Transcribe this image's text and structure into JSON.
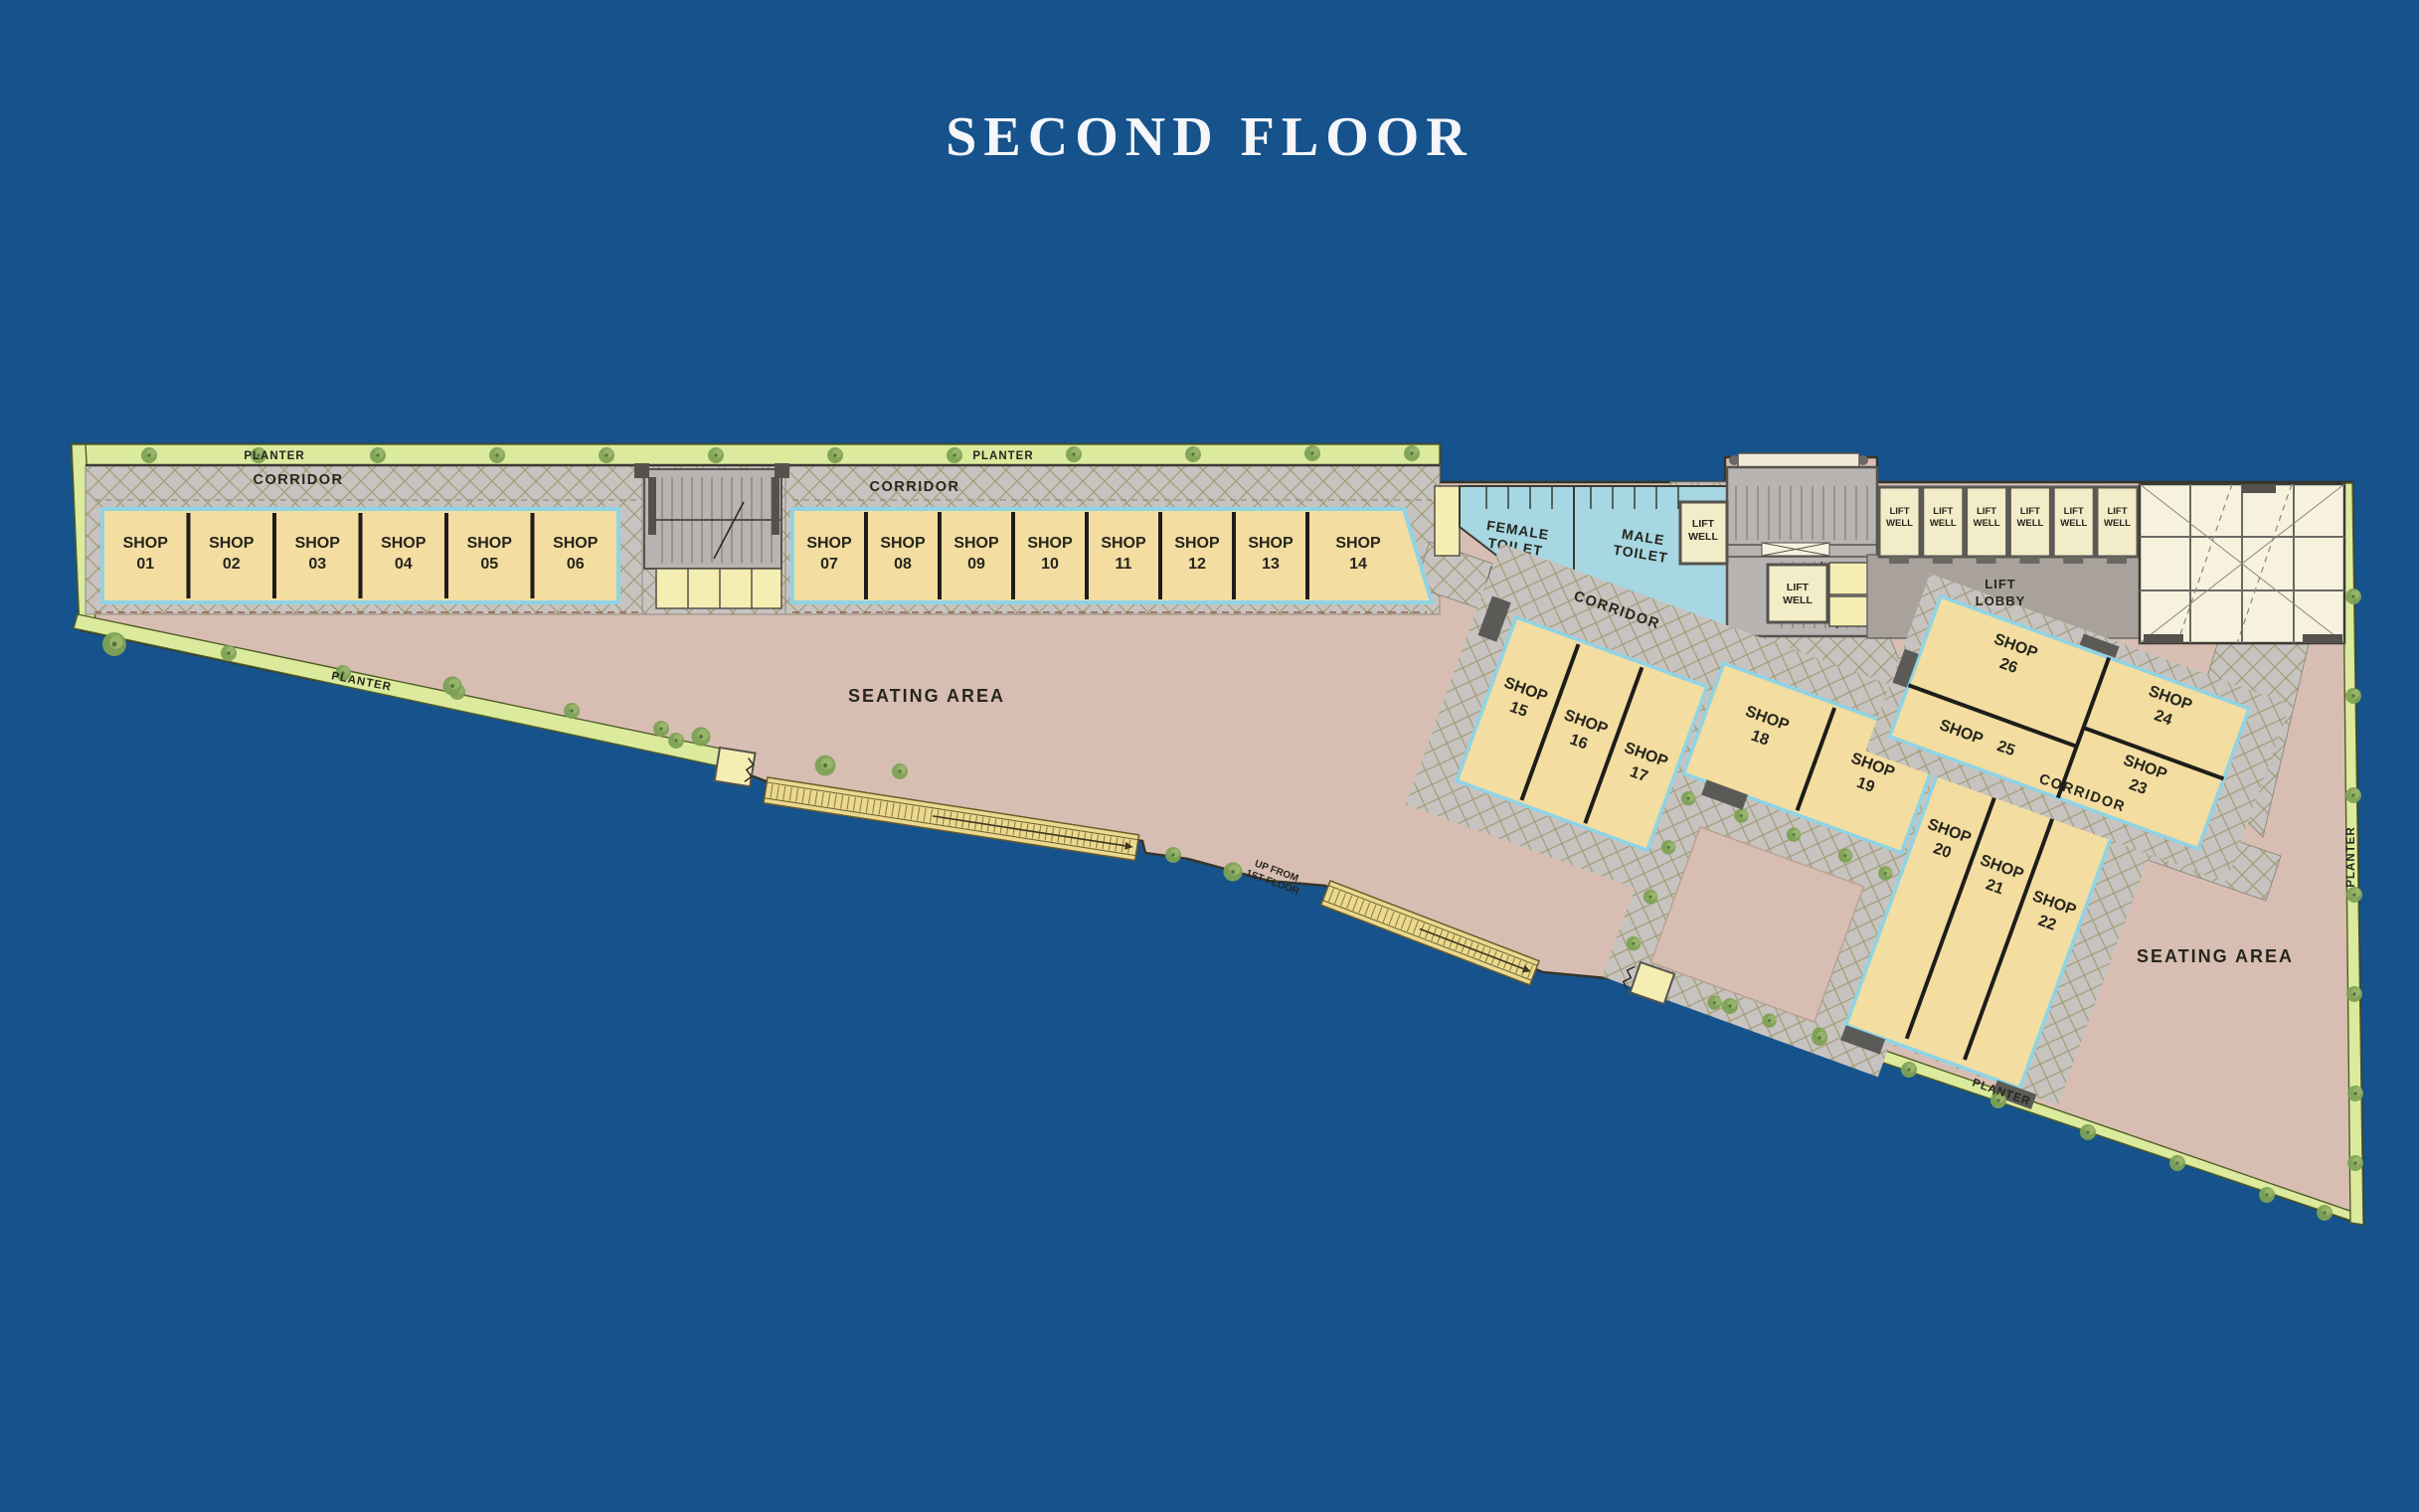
{
  "title": "SECOND FLOOR",
  "labels": {
    "shop_word": "SHOP",
    "planter": "PLANTER",
    "corridor": "CORRIDOR",
    "seating_area": "SEATING AREA",
    "female_line1": "FEMALE",
    "female_line2": "TOILET",
    "male_line1": "MALE",
    "male_line2": "TOILET",
    "lift_line1": "LIFT",
    "lift_line2": "WELL",
    "lobby_line1": "LIFT",
    "lobby_line2": "LOBBY",
    "up_line1": "UP FROM",
    "up_line2": "1ST FLOOR"
  },
  "shops": [
    {
      "number": "01"
    },
    {
      "number": "02"
    },
    {
      "number": "03"
    },
    {
      "number": "04"
    },
    {
      "number": "05"
    },
    {
      "number": "06"
    },
    {
      "number": "07"
    },
    {
      "number": "08"
    },
    {
      "number": "09"
    },
    {
      "number": "10"
    },
    {
      "number": "11"
    },
    {
      "number": "12"
    },
    {
      "number": "13"
    },
    {
      "number": "14"
    },
    {
      "number": "15"
    },
    {
      "number": "16"
    },
    {
      "number": "17"
    },
    {
      "number": "18"
    },
    {
      "number": "19"
    },
    {
      "number": "20"
    },
    {
      "number": "21"
    },
    {
      "number": "22"
    },
    {
      "number": "23"
    },
    {
      "number": "24"
    },
    {
      "number": "25"
    },
    {
      "number": "26"
    }
  ],
  "colors": {
    "background": "#16528c",
    "shop_fill": "#f3dda0",
    "shop_border": "#8fd4e6",
    "corridor_fill": "#c7c3c0",
    "hatch_line": "#a19c74",
    "seating_fill": "#d8beb2",
    "planter_fill": "#dcea9e",
    "toilet_fill": "#a6d7e2",
    "lift_fill": "#f3ecc8",
    "atrium_fill": "#f7f2dd",
    "stair_fill": "#b7b4b1",
    "lobby_fill": "#a9a19b",
    "title_color": "#f4f6f9"
  }
}
